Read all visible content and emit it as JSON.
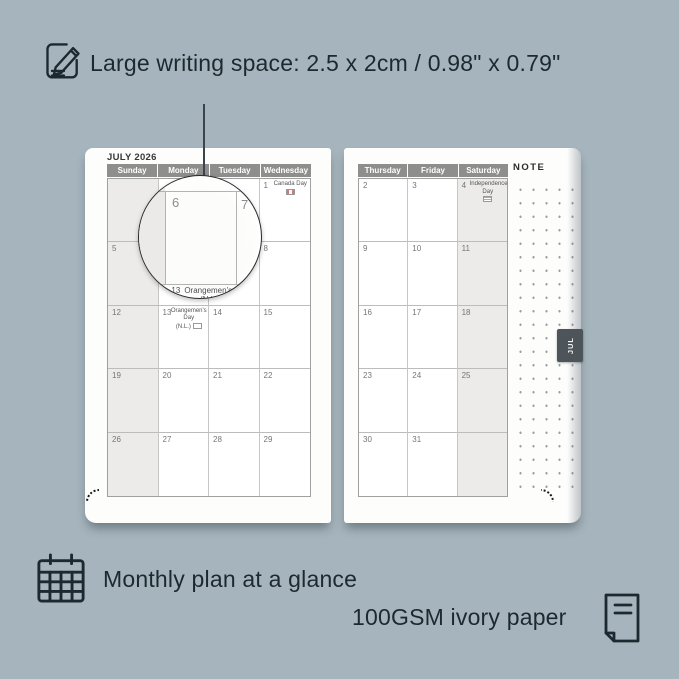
{
  "page": {
    "background": "#a6b5bd",
    "ink": "#1d2930"
  },
  "annotations": {
    "top_feature": "Large writing space: 2.5 x 2cm / 0.98\" x 0.79\"",
    "bottom_feature_monthly": "Monthly plan at a glance",
    "bottom_feature_paper": "100GSM ivory paper"
  },
  "calendar": {
    "month_title": "JULY 2026",
    "left_page": {
      "day_headers": [
        "Sunday",
        "Monday",
        "Tuesday",
        "Wednesday"
      ],
      "cells": [
        {
          "day": ""
        },
        {
          "day": ""
        },
        {
          "day": ""
        },
        {
          "day": "1",
          "holiday": "Canada Day"
        },
        {
          "day": "5"
        },
        {
          "day": "6"
        },
        {
          "day": "7"
        },
        {
          "day": "8"
        },
        {
          "day": "12"
        },
        {
          "day": "13",
          "holiday": "Orangemen's Day",
          "holiday_note": "(N.L.)"
        },
        {
          "day": "14"
        },
        {
          "day": "15"
        },
        {
          "day": "19"
        },
        {
          "day": "20"
        },
        {
          "day": "21"
        },
        {
          "day": "22"
        },
        {
          "day": "26"
        },
        {
          "day": "27"
        },
        {
          "day": "28"
        },
        {
          "day": "29"
        }
      ]
    },
    "right_page": {
      "day_headers": [
        "Thursday",
        "Friday",
        "Saturday"
      ],
      "note_label": "NOTE",
      "month_tab": "JUL",
      "cells": [
        {
          "day": "2"
        },
        {
          "day": "3"
        },
        {
          "day": "4",
          "holiday": "Independence Day"
        },
        {
          "day": "9"
        },
        {
          "day": "10"
        },
        {
          "day": "11"
        },
        {
          "day": "16"
        },
        {
          "day": "17"
        },
        {
          "day": "18"
        },
        {
          "day": "23"
        },
        {
          "day": "24"
        },
        {
          "day": "25"
        },
        {
          "day": "30"
        },
        {
          "day": "31"
        },
        {
          "day": ""
        }
      ]
    },
    "magnifier": {
      "day_left": "6",
      "day_right": "7",
      "caption_day": "13",
      "caption": "Orangemen's Day",
      "caption_note": "(N.L.)"
    }
  }
}
